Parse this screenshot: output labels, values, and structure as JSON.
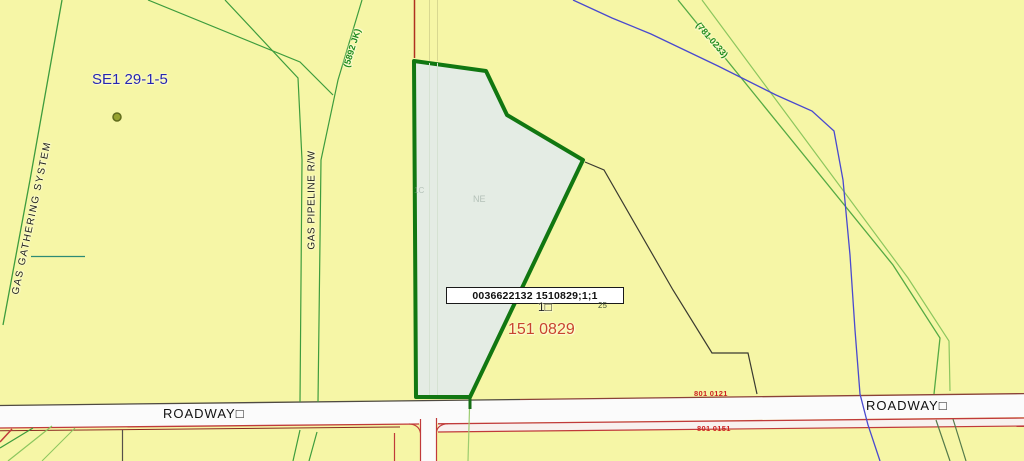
{
  "app": {
    "type": "gis-parcel-map-viewer"
  },
  "colors": {
    "background": "#f6f6a6",
    "parcel_fill": "#e4ece4",
    "parcel_stroke": "#117711",
    "pipeline_green": "#3d9c3d",
    "pipeline_green_light": "#8cc65e",
    "stream_blue": "#4949cf",
    "road_red": "#c03a3a",
    "label_blue": "#2626b0",
    "label_red": "#c8442e",
    "label_green": "#1f8c1f"
  },
  "labels": {
    "section": "SE1 29-1-5",
    "gas_gathering_line": "GAS GATHERING SYSTEM",
    "gas_pipeline_rw": "GAS PIPELINE R/W",
    "pipeline_id_left": "(5892 JK)",
    "pipeline_id_right": "(781 0233)",
    "parcel_faint_left": "1C",
    "parcel_faint_center": "NE",
    "selected_parcel_id": "0036622132 1510829;1;1",
    "lot_number": "1□",
    "adjacent_lot_number": "25",
    "plan_number": "151 0829",
    "roadway_left": "ROADWAY□",
    "roadway_right": "ROADWAY□",
    "road_plan_upper": "801 0121",
    "road_plan_lower": "801 0151"
  }
}
